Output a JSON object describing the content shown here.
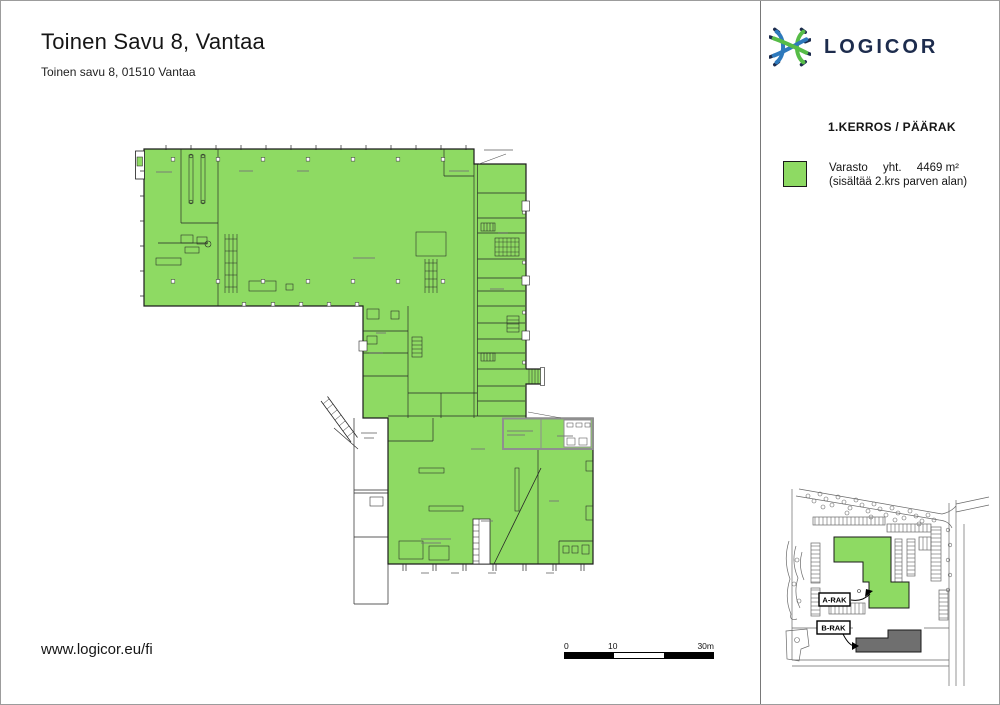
{
  "header": {
    "title": "Toinen Savu 8, Vantaa",
    "subtitle": "Toinen savu 8, 01510 Vantaa"
  },
  "logo": {
    "brand": "LOGICOR",
    "mark_green": "#56BC47",
    "mark_blue": "#2E79BC",
    "navy": "#1D2C4D"
  },
  "panel": {
    "floor_label": "1.KERROS / PÄÄRAK",
    "legend": {
      "name": "Varasto",
      "total_label": "yht.",
      "area": "4469 m²",
      "note": "(sisältää 2.krs parven alan)",
      "swatch_color": "#8EDA63"
    },
    "site_map": {
      "building_a": "A-RAK",
      "building_b": "B-RAK",
      "building_b_color": "#6F6F6F"
    }
  },
  "plan": {
    "fill": "#8EDA63",
    "outline": "#1C1C1C"
  },
  "scale_bar": {
    "start": "0",
    "mid": "10",
    "end": "30m"
  },
  "footer": {
    "website": "www.logicor.eu/fi"
  }
}
